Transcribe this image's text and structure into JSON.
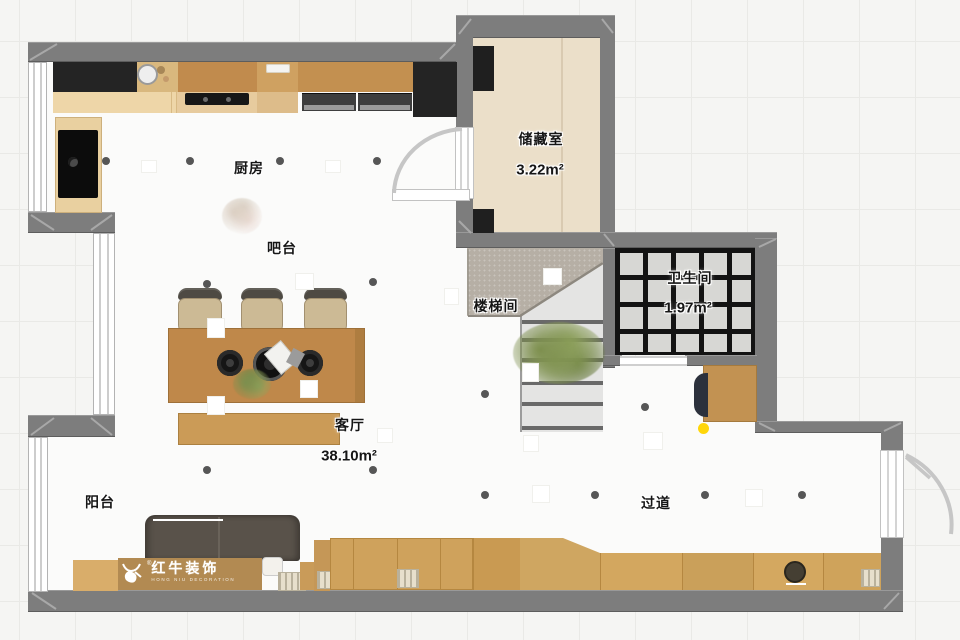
{
  "plan_title": "室内平面布置图",
  "rooms": [
    {
      "id": "kitchen",
      "label": "厨房"
    },
    {
      "id": "bar",
      "label": "吧台"
    },
    {
      "id": "storage",
      "label": "储藏室",
      "area": "3.22m²"
    },
    {
      "id": "stairwell",
      "label": "楼梯间"
    },
    {
      "id": "bathroom",
      "label": "卫生间",
      "area": "1.97m²"
    },
    {
      "id": "living",
      "label": "客厅",
      "area": "38.10m²"
    },
    {
      "id": "balcony",
      "label": "阳台"
    },
    {
      "id": "hallway",
      "label": "过道"
    }
  ],
  "watermark": {
    "brand": "红牛装饰",
    "subtitle": "HONG NIU DECORATION",
    "registered": "®"
  },
  "palette": {
    "wall": "#7d7d7d",
    "wood_dark": "#c18b4d",
    "wood_light": "#ecd4a7",
    "storage_floor": "#ebdfc9",
    "bath_tile": "#d7d7d4",
    "bath_grout": "#131313",
    "stair_concrete": "#b6afa5",
    "sofa": "#59524a",
    "accent_dot": "#ffd60a",
    "plant_green": "#7d8f4e"
  }
}
